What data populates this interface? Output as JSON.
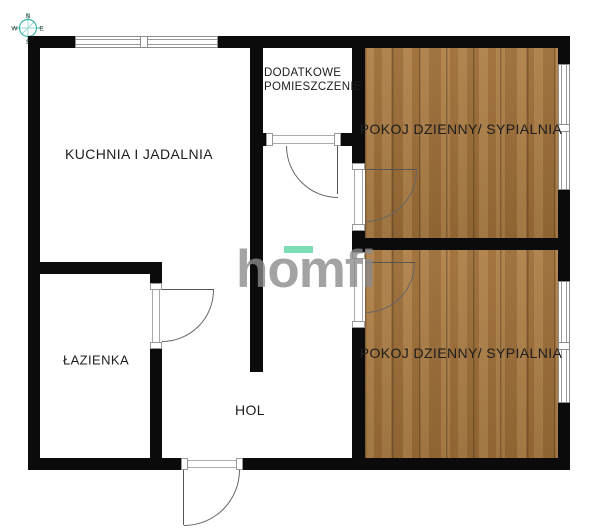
{
  "plan": {
    "compass": {
      "n": "N",
      "e": "E",
      "s": "S",
      "w": "W"
    },
    "rooms": {
      "kitchen": {
        "label": "KUCHNIA I  JADALNIA"
      },
      "additional": {
        "line1": "DODATKOWE",
        "line2": "POMIESZCZENIE"
      },
      "living_top": {
        "label": "POKOJ DZIENNY/ SYPIALNIA"
      },
      "living_bottom": {
        "label": "POKOJ DZIENNY/ SYPIALNIA"
      },
      "bathroom": {
        "label": "ŁAZIENKA"
      },
      "hall": {
        "label": "HOL"
      }
    },
    "watermark": {
      "text": "homfi",
      "accent_color": "#57d5a0",
      "text_color": "#8a8a8a"
    },
    "colors": {
      "wall": "#0b0b0b",
      "wood_floor": "#a0743e",
      "compass_teal": "#3bb6a8",
      "label_text": "#1d1d1d",
      "background": "#ffffff"
    }
  }
}
